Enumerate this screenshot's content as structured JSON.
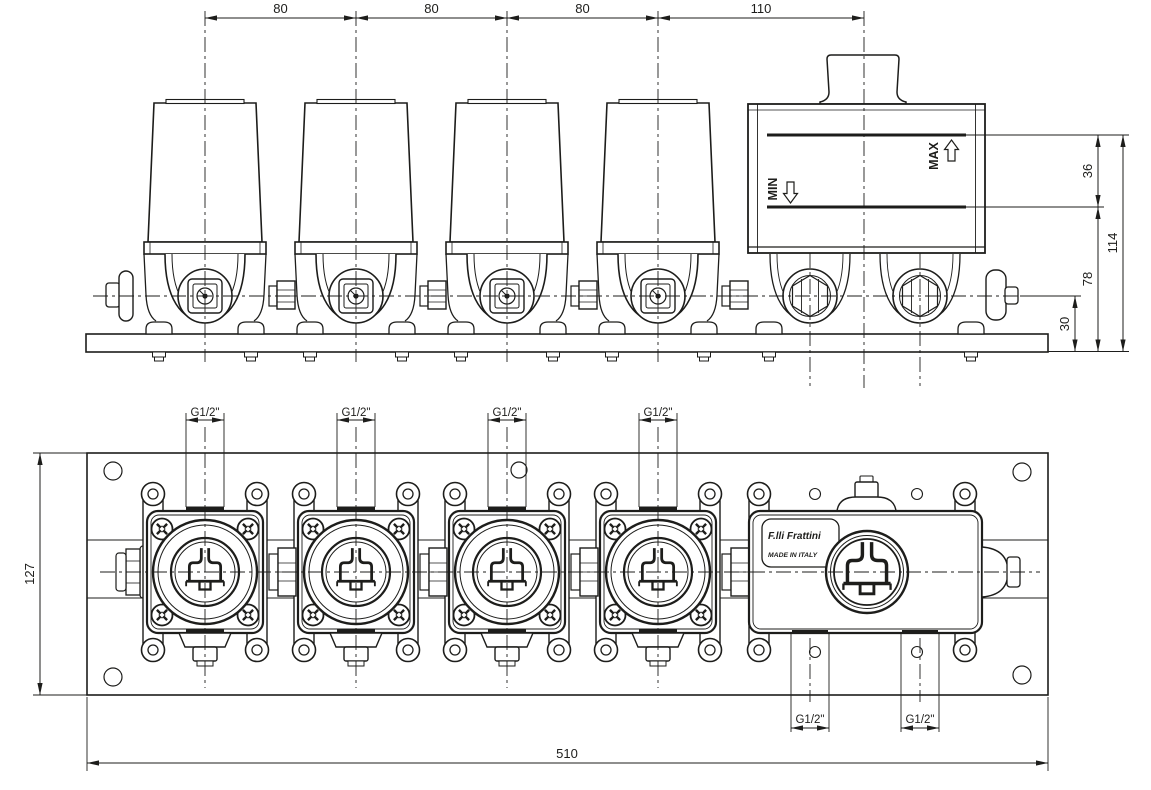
{
  "colors": {
    "ink": "#1d1d1b",
    "paper": "#ffffff"
  },
  "labels": {
    "max": "MAX",
    "min": "MIN",
    "brand": "F.lli Frattini",
    "made_in": "MADE IN ITALY"
  },
  "dimensions": {
    "top_spacing": [
      "80",
      "80",
      "80",
      "110"
    ],
    "right": {
      "max_to_min": "36",
      "overall_height": "114",
      "min_to_base": "78",
      "axis_to_base": "30"
    },
    "front": {
      "plate_height": "127",
      "plate_width": "510"
    },
    "thread": "G1/2\""
  }
}
